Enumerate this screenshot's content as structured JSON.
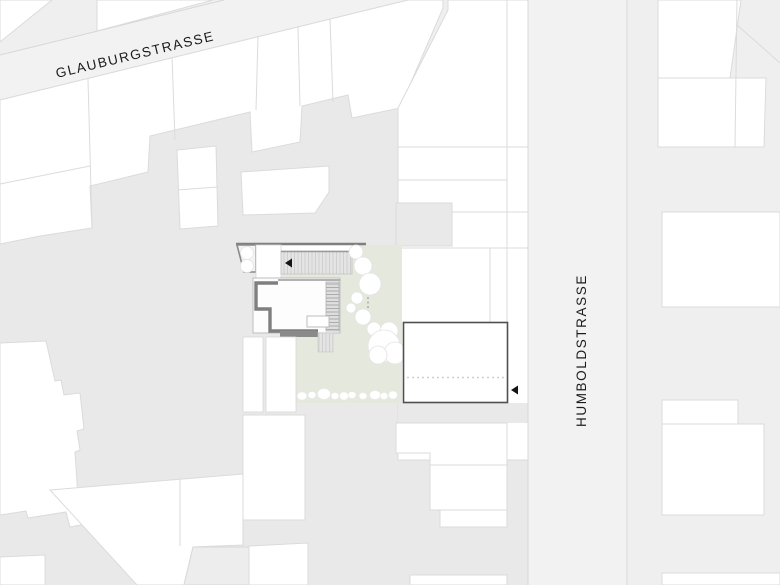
{
  "meta": {
    "type": "architectural-site-plan",
    "description": "Black-and-white urban site plan with project building, garden and two labeled streets"
  },
  "streets": {
    "glauburgstrasse": {
      "label": "GLAUBURGSTRASSE",
      "orientation": "diagonal-top-left"
    },
    "humboldstrasse": {
      "label": "HUMBOLDSTRASSE",
      "orientation": "vertical-right"
    }
  },
  "site": {
    "garden": "landscaped garden with trees and shrubs",
    "main_building": "project building with thick gray walls and roof hatch",
    "planned_building": "outlined rectangular volume with dashed centre line",
    "markers": {
      "west_entrance_arrow": "left-pointing black triangle at project building",
      "east_entrance_arrow": "left-pointing black triangle at Humboldstrasse building"
    }
  },
  "colors": {
    "background": "#efefef",
    "block_interior": "#e9e9e9",
    "street_fill": "#f2f2f2",
    "parcel_fill": "#ffffff",
    "parcel_line": "#dbdbdb",
    "site_wall": "#7f7f7f",
    "garden": "#e5e9dd",
    "tree_fill": "#ffffff",
    "arrow": "#141414",
    "planned_outline": "#4f4f4f",
    "dashed_line": "#dcc9c9"
  }
}
